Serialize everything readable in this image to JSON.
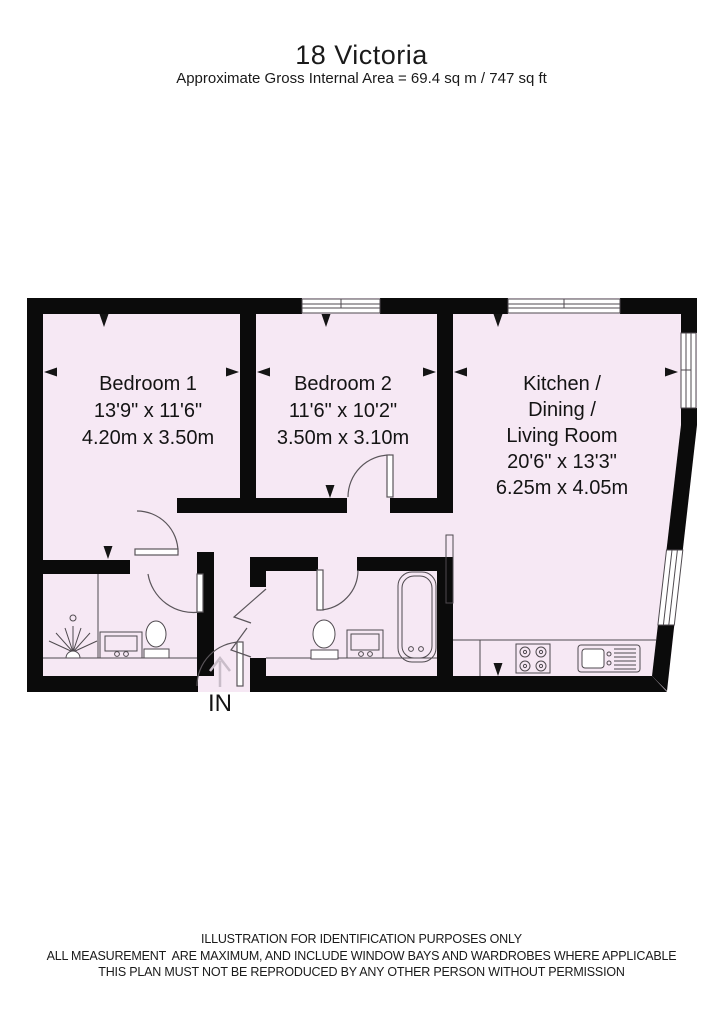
{
  "header": {
    "title": "18 Victoria",
    "subtitle": "Approximate Gross Internal Area = 69.4 sq m / 747 sq ft"
  },
  "rooms": [
    {
      "id": "bedroom-1",
      "lines": [
        "Bedroom 1",
        "13'9\" x 11'6\"",
        "4.20m x 3.50m"
      ]
    },
    {
      "id": "bedroom-2",
      "lines": [
        "Bedroom 2",
        "11'6\" x 10'2\"",
        "3.50m x 3.10m"
      ]
    },
    {
      "id": "kitchen-dining-living",
      "lines": [
        "Kitchen /",
        "Dining /",
        "Living Room",
        "20'6\" x 13'3\"",
        "6.25m x 4.05m"
      ]
    }
  ],
  "entrance_label": "IN",
  "footer": {
    "line1": "ILLUSTRATION FOR IDENTIFICATION PURPOSES ONLY",
    "line2": "ALL MEASUREMENT  ARE MAXIMUM, AND INCLUDE WINDOW BAYS AND WARDROBES WHERE APPLICABLE",
    "line3": "THIS PLAN MUST NOT BE REPRODUCED BY ANY OTHER PERSON WITHOUT PERMISSION"
  },
  "colors": {
    "wall": "#0b0b0b",
    "room_fill": "#f6e8f4",
    "fixture_line": "#4f4a4f",
    "entrance_arrow": "#c9bdc9",
    "text": "#141414"
  }
}
